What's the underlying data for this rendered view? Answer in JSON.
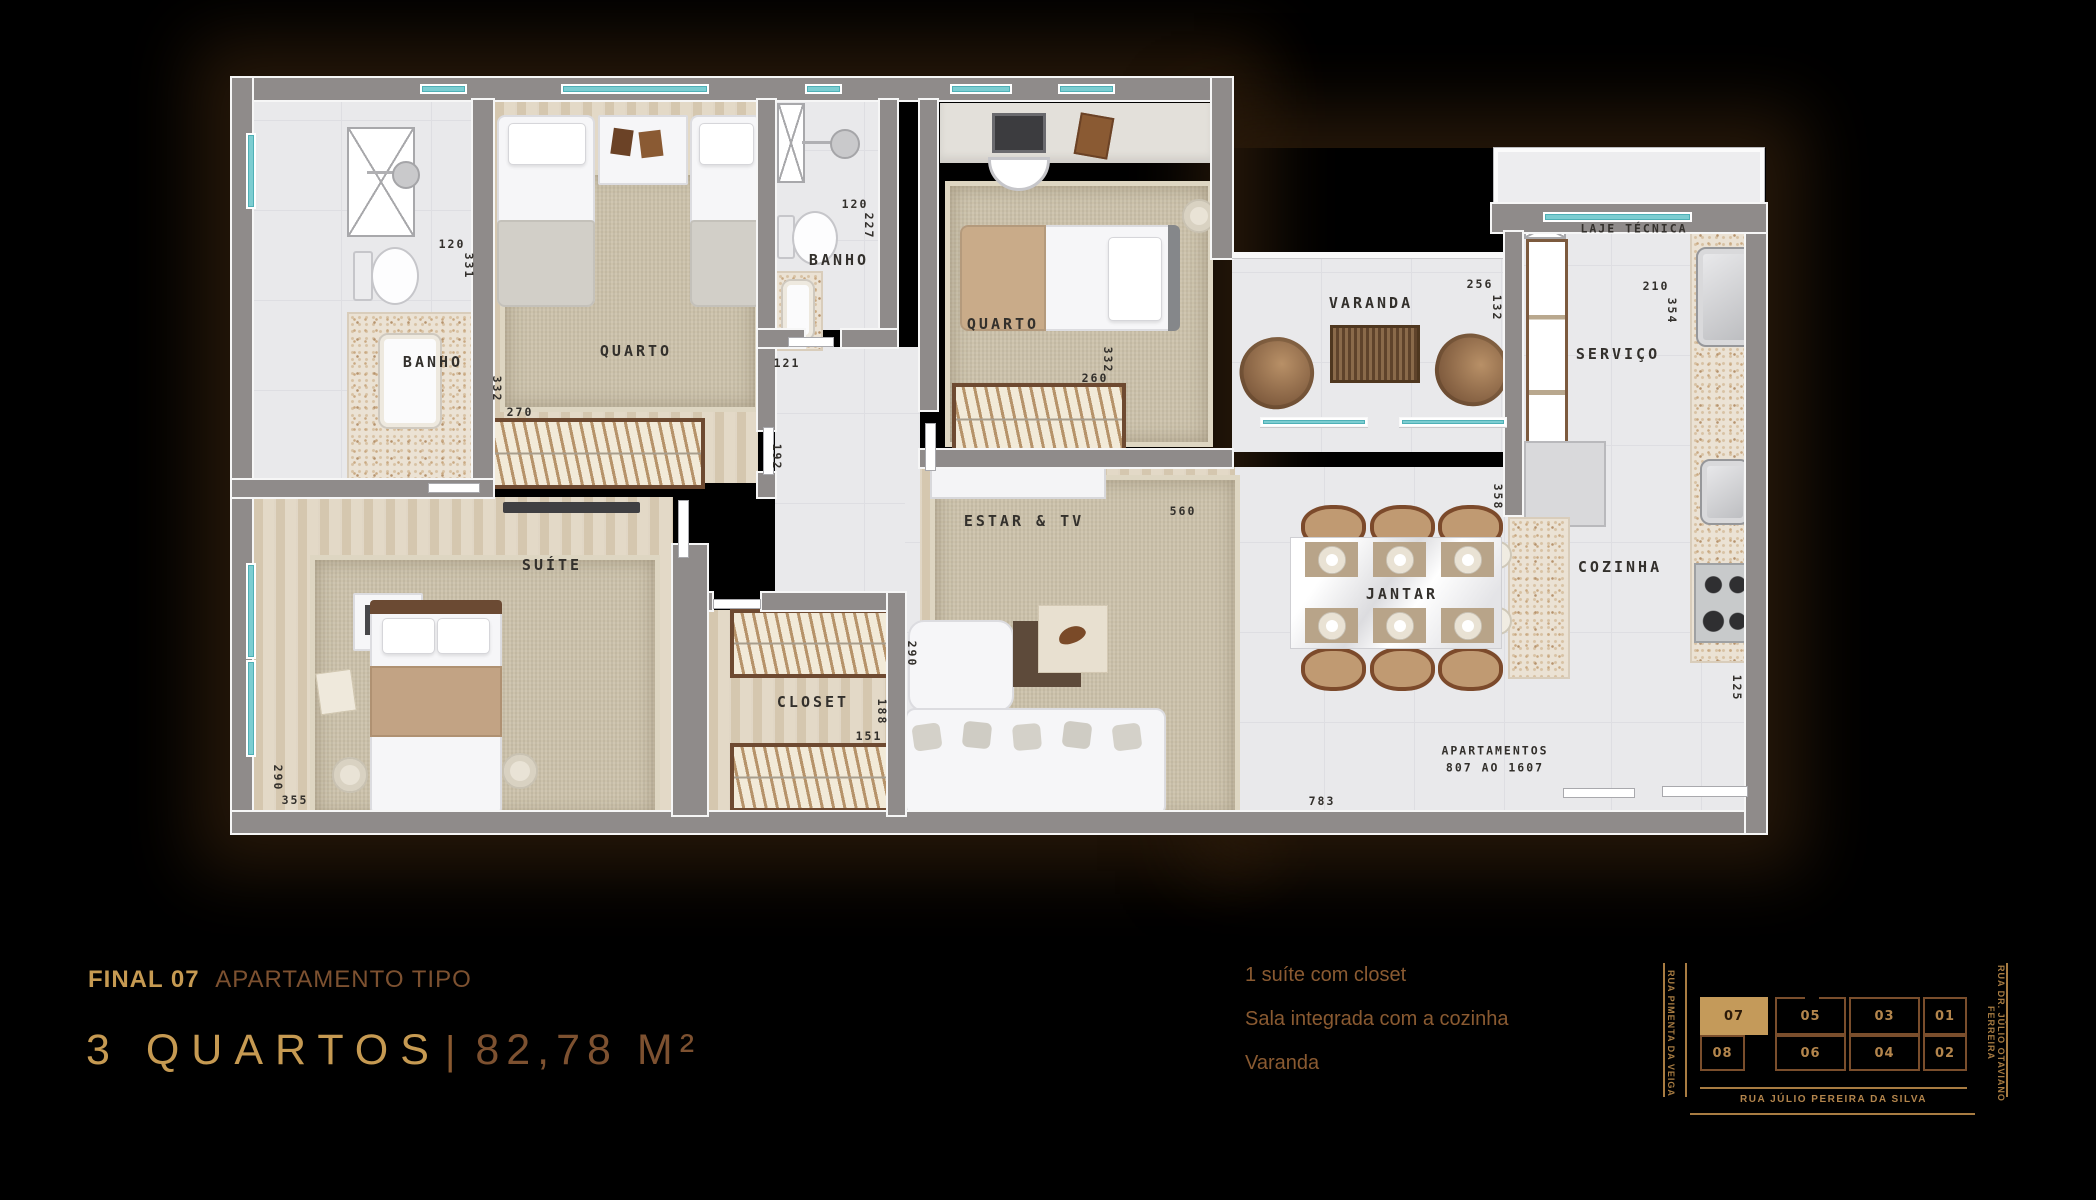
{
  "page": {
    "width": 2096,
    "height": 1200,
    "background": "#000000"
  },
  "plan": {
    "rooms": [
      {
        "label": "BANHO",
        "x": 433,
        "y": 363
      },
      {
        "label": "QUARTO",
        "x": 636,
        "y": 352
      },
      {
        "label": "BANHO",
        "x": 839,
        "y": 261
      },
      {
        "label": "QUARTO",
        "x": 1003,
        "y": 325
      },
      {
        "label": "VARANDA",
        "x": 1371,
        "y": 304
      },
      {
        "label": "LAJE TÉCNICA",
        "x": 1634,
        "y": 229,
        "small": true
      },
      {
        "label": "SERVIÇO",
        "x": 1618,
        "y": 355
      },
      {
        "label": "SUÍTE",
        "x": 552,
        "y": 566
      },
      {
        "label": "CLOSET",
        "x": 813,
        "y": 703
      },
      {
        "label": "ESTAR & TV",
        "x": 1024,
        "y": 522
      },
      {
        "label": "JANTAR",
        "x": 1402,
        "y": 595
      },
      {
        "label": "COZINHA",
        "x": 1620,
        "y": 568
      },
      {
        "label": "APARTAMENTOS\n807 AO 1607",
        "x": 1495,
        "y": 759,
        "small": true
      }
    ],
    "dims": [
      {
        "t": "120",
        "x": 452,
        "y": 244
      },
      {
        "t": "331",
        "x": 469,
        "y": 266,
        "v": true
      },
      {
        "t": "332",
        "x": 497,
        "y": 389,
        "v": true
      },
      {
        "t": "270",
        "x": 520,
        "y": 412
      },
      {
        "t": "120",
        "x": 855,
        "y": 204
      },
      {
        "t": "227",
        "x": 869,
        "y": 226,
        "v": true
      },
      {
        "t": "121",
        "x": 787,
        "y": 363
      },
      {
        "t": "192",
        "x": 777,
        "y": 457,
        "v": true
      },
      {
        "t": "332",
        "x": 1108,
        "y": 360,
        "v": true
      },
      {
        "t": "260",
        "x": 1095,
        "y": 378
      },
      {
        "t": "560",
        "x": 1183,
        "y": 511
      },
      {
        "t": "290",
        "x": 912,
        "y": 654,
        "v": true
      },
      {
        "t": "290",
        "x": 278,
        "y": 778,
        "v": true
      },
      {
        "t": "355",
        "x": 295,
        "y": 800
      },
      {
        "t": "188",
        "x": 882,
        "y": 712,
        "v": true
      },
      {
        "t": "151",
        "x": 869,
        "y": 736
      },
      {
        "t": "256",
        "x": 1480,
        "y": 284
      },
      {
        "t": "132",
        "x": 1497,
        "y": 308,
        "v": true
      },
      {
        "t": "358",
        "x": 1498,
        "y": 497,
        "v": true
      },
      {
        "t": "210",
        "x": 1656,
        "y": 286
      },
      {
        "t": "354",
        "x": 1672,
        "y": 311,
        "v": true
      },
      {
        "t": "125",
        "x": 1737,
        "y": 688,
        "v": true
      },
      {
        "t": "783",
        "x": 1322,
        "y": 801
      }
    ]
  },
  "footer": {
    "final_label": "FINAL 07",
    "final_suffix": "APARTAMENTO TIPO",
    "rooms_count": "3 QUARTOS",
    "separator": "|",
    "area": "82,78 M²",
    "features": [
      "1 suíte com closet",
      "Sala integrada com a cozinha",
      "Varanda"
    ]
  },
  "minimap": {
    "street_left": "RUA PIMENTA DA VEIGA",
    "street_right": "RUA DR. JÚLIO OTAVIANO FERREIRA",
    "street_bottom": "RUA JÚLIO PEREIRA DA SILVA",
    "highlighted_unit": "07",
    "units_top": [
      "07",
      "05",
      "03",
      "01"
    ],
    "units_bottom": [
      "08",
      "06",
      "04",
      "02"
    ]
  },
  "colors": {
    "gold": "#c69a52",
    "brown": "#7d5130",
    "feature_text": "#8a5a31",
    "map_gold": "#b3854c",
    "unit_fill": "#c49a5a",
    "label_ink": "#33302c"
  }
}
